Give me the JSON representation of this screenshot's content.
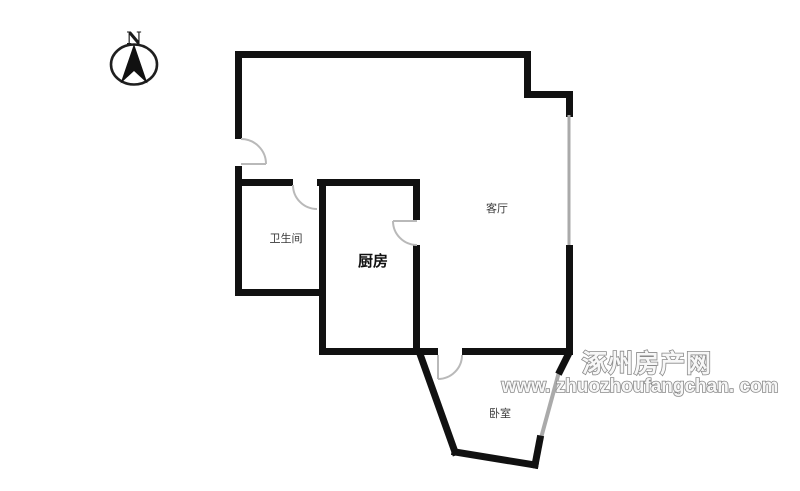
{
  "compass": {
    "north_label": "N"
  },
  "rooms": [
    {
      "id": "bathroom",
      "label": "卫生间"
    },
    {
      "id": "kitchen",
      "label": "厨房"
    },
    {
      "id": "living_room",
      "label": "客厅"
    },
    {
      "id": "bedroom",
      "label": "卧室"
    }
  ],
  "watermark": {
    "site_name": "涿州房产网",
    "url": "www. zhuozhoufangchan. com"
  },
  "colors": {
    "wall": "#111111",
    "window": "#aaaaaa",
    "door": "#b3b3b3",
    "label": "#3a3a3a",
    "watermark_outline": "#8a8a8a"
  }
}
